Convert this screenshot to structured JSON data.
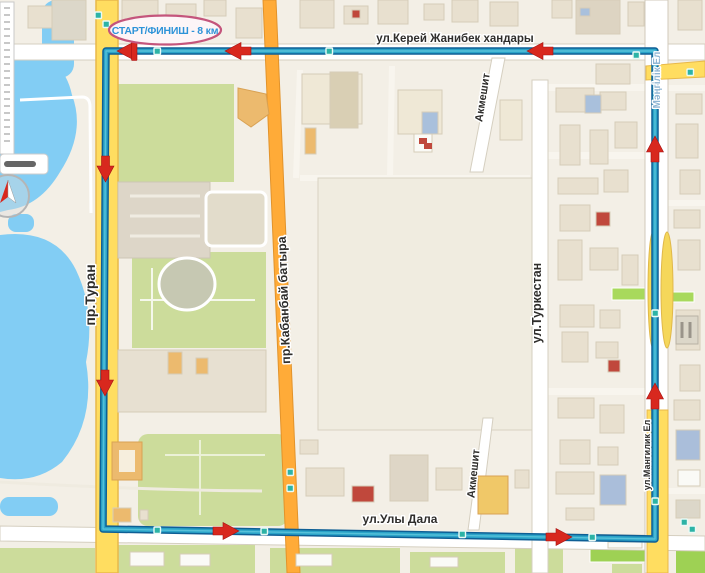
{
  "map": {
    "title_bubble": {
      "label": "СТАРТ/ФИНИШ - 8 км"
    },
    "streets": {
      "kerey_zhanibek_khandary": "ул.Керей Жанибек хандары",
      "turan": "пр.Туран",
      "kabanbay_batyra": "пр.Кабанбай батыра",
      "turkestan": "ул.Туркестан",
      "akmeshit_north": "Акмешит",
      "akmeshit_south": "Акмешит",
      "uly_dala": "ул.Улы Дала",
      "mangilik_el": "ул.Мангилик Ел",
      "mangilik_el_road_name": "Мәңгілік Ел"
    },
    "route": {
      "distance_km": 8,
      "shape": "closed rectangular loop",
      "direction": "counterclockwise",
      "line_color": "#2aa3c8",
      "casing_color": "#0e5f95",
      "arrow_color": "#d8281e",
      "stop_marker_color": "#2cb3a6",
      "bubble_text_color": "#2e93d8",
      "bubble_border_color": "#c4557c"
    },
    "palette": {
      "background": "#f3efe6",
      "water": "#82cdf4",
      "park_green": "#ccdc9b",
      "bright_green": "#9ed154",
      "road_yellow": "#ffdd60",
      "road_orange": "#ffab38",
      "building_beige": "#e8e0cf"
    }
  }
}
